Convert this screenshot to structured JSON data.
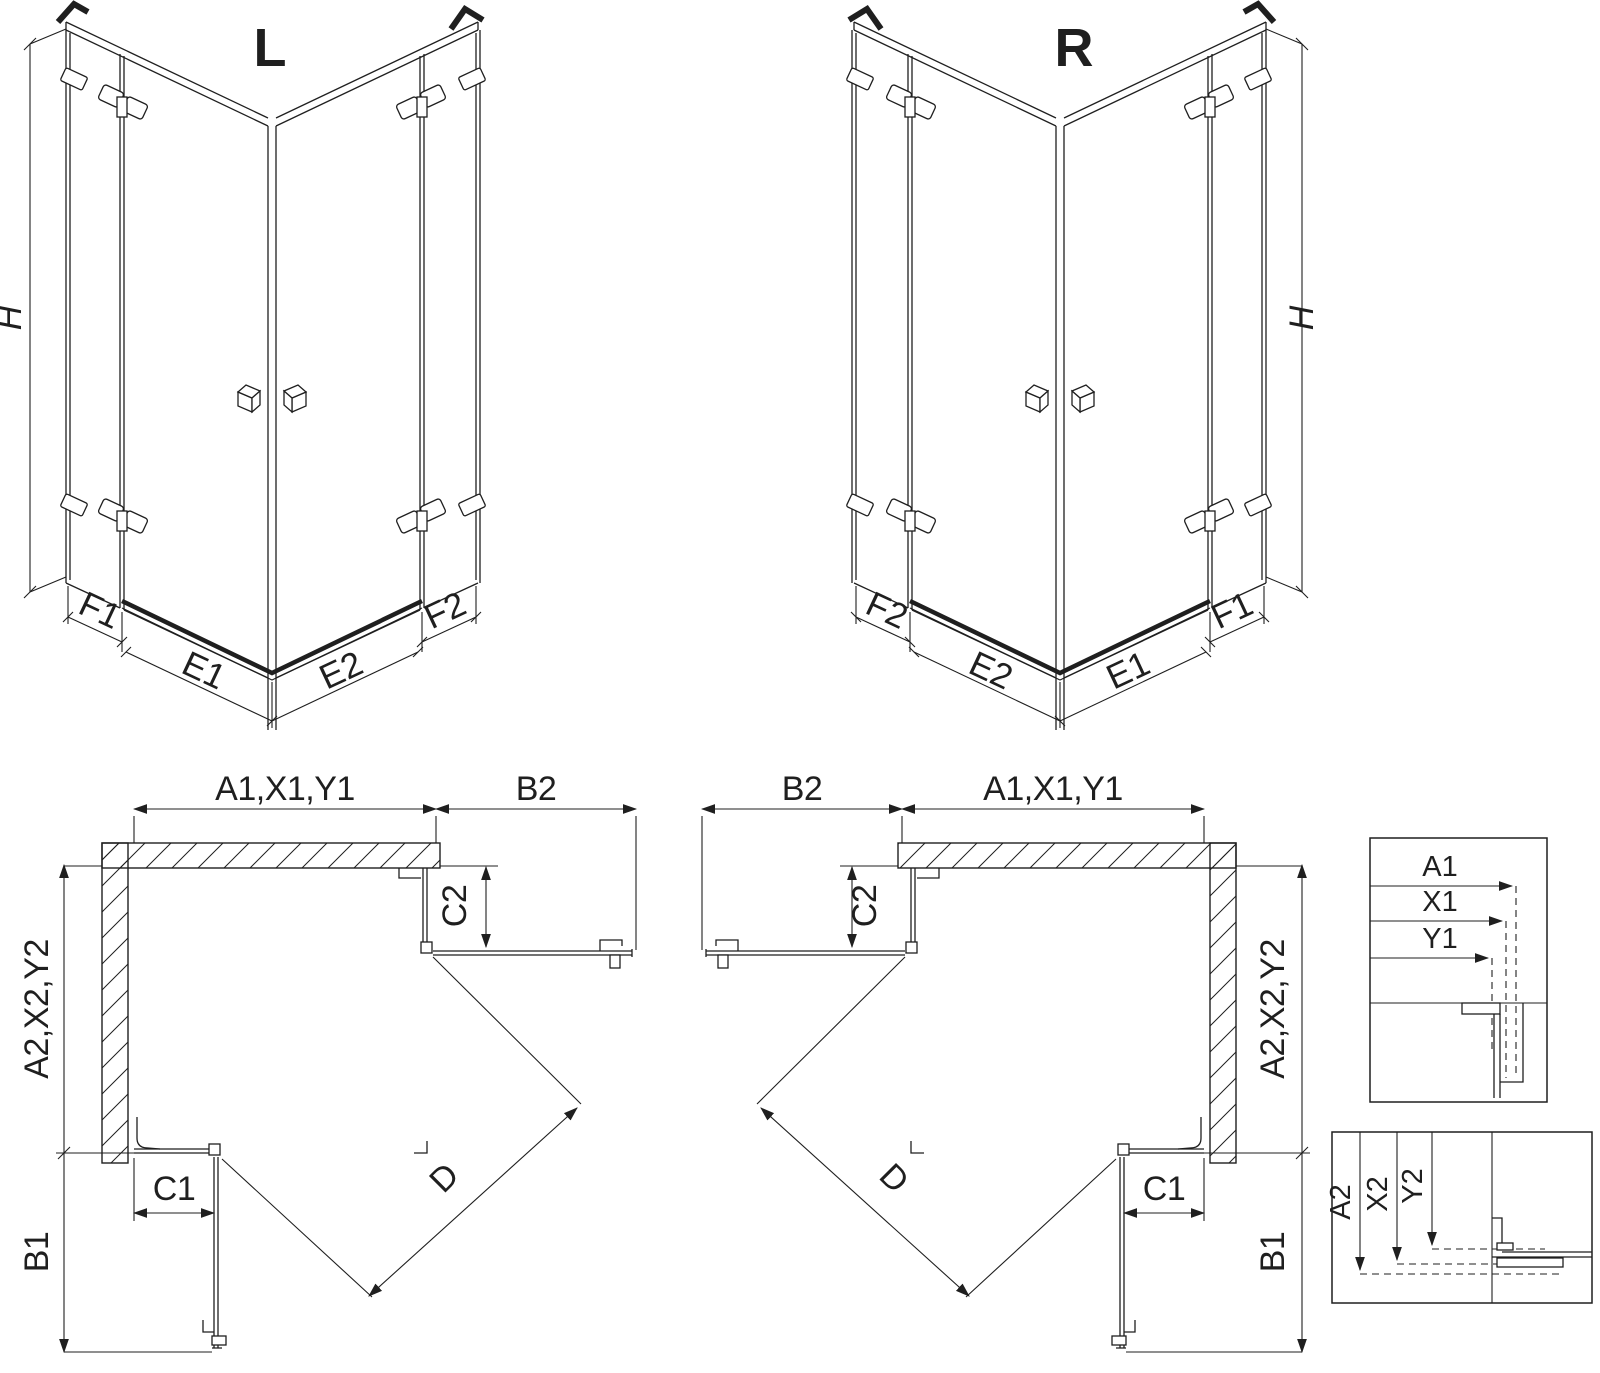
{
  "diagram": {
    "title_meaning": "shower enclosure dimension drawing, left and right variants",
    "colors": {
      "line": "#1f1f1f",
      "background": "#ffffff"
    },
    "view_l": {
      "title": "L",
      "dim_h": "H",
      "dim_f1": "F1",
      "dim_e1": "E1",
      "dim_e2": "E2",
      "dim_f2": "F2"
    },
    "view_r": {
      "title": "R",
      "dim_h": "H",
      "dim_f1": "F1",
      "dim_e1": "E1",
      "dim_e2": "E2",
      "dim_f2": "F2"
    },
    "plan_l": {
      "dim_top": "A1,X1,Y1",
      "dim_b2": "B2",
      "dim_c2": "C2",
      "dim_side": "A2,X2,Y2",
      "dim_c1": "C1",
      "dim_b1": "B1",
      "dim_d": "D"
    },
    "plan_r": {
      "dim_top": "A1,X1,Y1",
      "dim_b2": "B2",
      "dim_c2": "C2",
      "dim_side": "A2,X2,Y2",
      "dim_c1": "C1",
      "dim_b1": "B1",
      "dim_d": "D"
    },
    "detail_h": {
      "a1": "A1",
      "x1": "X1",
      "y1": "Y1"
    },
    "detail_v": {
      "a2": "A2",
      "x2": "X2",
      "y2": "Y2"
    }
  }
}
